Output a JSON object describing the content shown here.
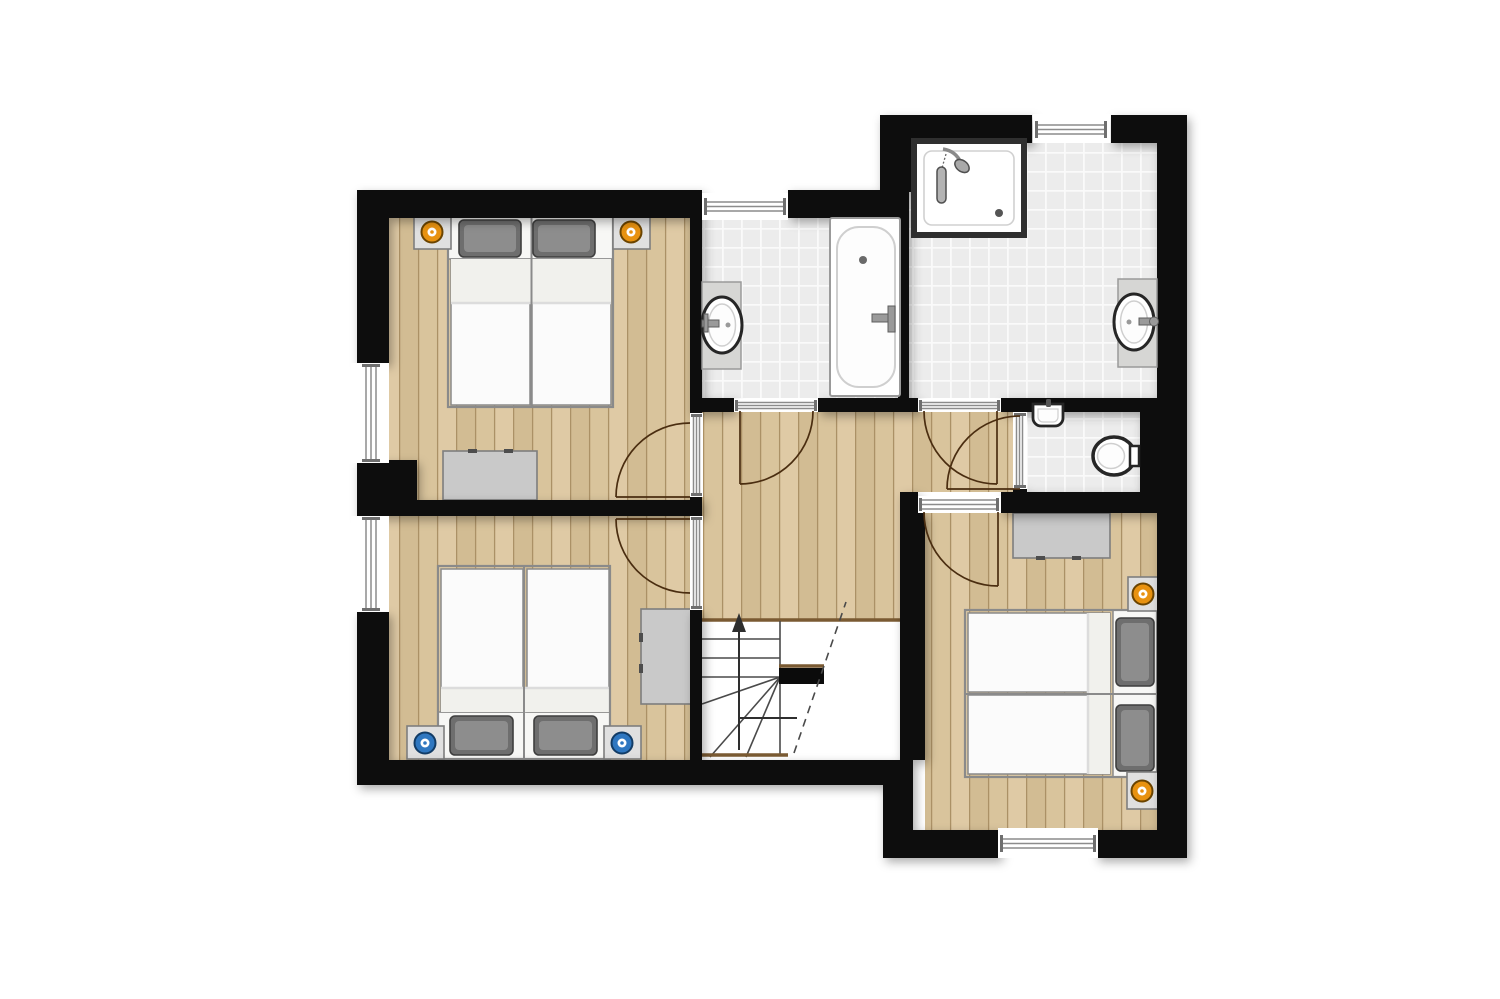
{
  "meta": {
    "type": "architectural-floor-plan",
    "view": "2d-top-down-color",
    "aria": "Upper floor plan: three bedrooms with double beds, two bathrooms, separate WC, hallway landing and winder staircase"
  },
  "canvas": {
    "width": 1500,
    "height": 999,
    "background": "#ffffff"
  },
  "colors": {
    "bg": "#ffffff",
    "wall": "#0b0b0b",
    "wood": "#d9c49c",
    "wood2": "#d2bc93",
    "wood3": "#dfcaa5",
    "woodLine": "#ab9166",
    "woodTrim": "#7a5a32",
    "tile": "#ececec",
    "tileLine": "#fafafa",
    "glazing": "#8c8c8c",
    "glazingCap": "#6f6f6f",
    "bedFrame": "#8a8a8a",
    "bedBand": "#f7f7f5",
    "mattress": "#fbfbfb",
    "sheet": "#f1f1ed",
    "pillow": "#6e6e6e",
    "pillowEdge": "#3f3f3f",
    "pillowLight": "#8d8d8d",
    "furn": "#c9c9c9",
    "furnLight": "#e0e0e0",
    "furnBorder": "#7e7e7e",
    "handle": "#4d4d4d",
    "vanity": "#d6d6d4",
    "fixtureRim": "#262626",
    "fixtureInner": "#cfcfcf",
    "metal": "#9a9a9a",
    "metalDark": "#5e5e5e",
    "accentOrange": "#e89210",
    "accentOrangeEdge": "#6b4400",
    "accentBlue": "#2f77c0",
    "accentBlueEdge": "#123c66",
    "arc": "#4a2d10",
    "stairLine": "#4a4a4a",
    "arrow": "#2e2e2e"
  },
  "rooms": [
    {
      "name": "bedroom-top-left",
      "floor": "wood-planks",
      "furniture": [
        "double-bed-two-mattresses",
        "pillow-left",
        "pillow-right",
        "nightstand-with-orange-marker-left",
        "nightstand-with-orange-marker-right",
        "dresser"
      ],
      "openings": [
        "window-left-wall",
        "door-to-hallway"
      ]
    },
    {
      "name": "bedroom-bottom-left",
      "floor": "wood-planks",
      "furniture": [
        "double-bed-two-mattresses",
        "pillow-left",
        "pillow-right",
        "nightstand-with-blue-marker-left",
        "nightstand-with-blue-marker-right",
        "dresser"
      ],
      "openings": [
        "window-left-wall",
        "door-to-hallway"
      ]
    },
    {
      "name": "bathroom-middle",
      "floor": "tiles",
      "fixtures": [
        "bathtub-with-faucet",
        "oval-washbasin-on-vanity"
      ],
      "openings": [
        "window-top-wall",
        "door-to-hallway"
      ]
    },
    {
      "name": "bathroom-top-right",
      "floor": "tiles",
      "fixtures": [
        "corner-shower-with-head",
        "oval-washbasin-on-vanity"
      ],
      "openings": [
        "window-top-wall",
        "door-to-hallway"
      ]
    },
    {
      "name": "wc",
      "floor": "tiles",
      "fixtures": [
        "toilet",
        "small-wall-basin"
      ],
      "openings": [
        "door-to-hallway"
      ]
    },
    {
      "name": "bedroom-right",
      "floor": "wood-planks",
      "furniture": [
        "double-bed-two-mattresses",
        "pillow-top",
        "pillow-bottom",
        "nightstand-with-orange-marker-top",
        "nightstand-with-orange-marker-bottom",
        "dresser"
      ],
      "openings": [
        "window-bottom-wall",
        "door-to-hallway"
      ]
    },
    {
      "name": "hallway-landing",
      "floor": "wood-planks",
      "features": [
        "winder-staircase",
        "up-direction-arrow",
        "stairwell-void",
        "dashed-headroom-line",
        "landing-guard"
      ]
    }
  ],
  "counts": {
    "bedrooms": 3,
    "bathrooms": 2,
    "wc": 1,
    "windows": 5,
    "interior-doors": 6
  }
}
